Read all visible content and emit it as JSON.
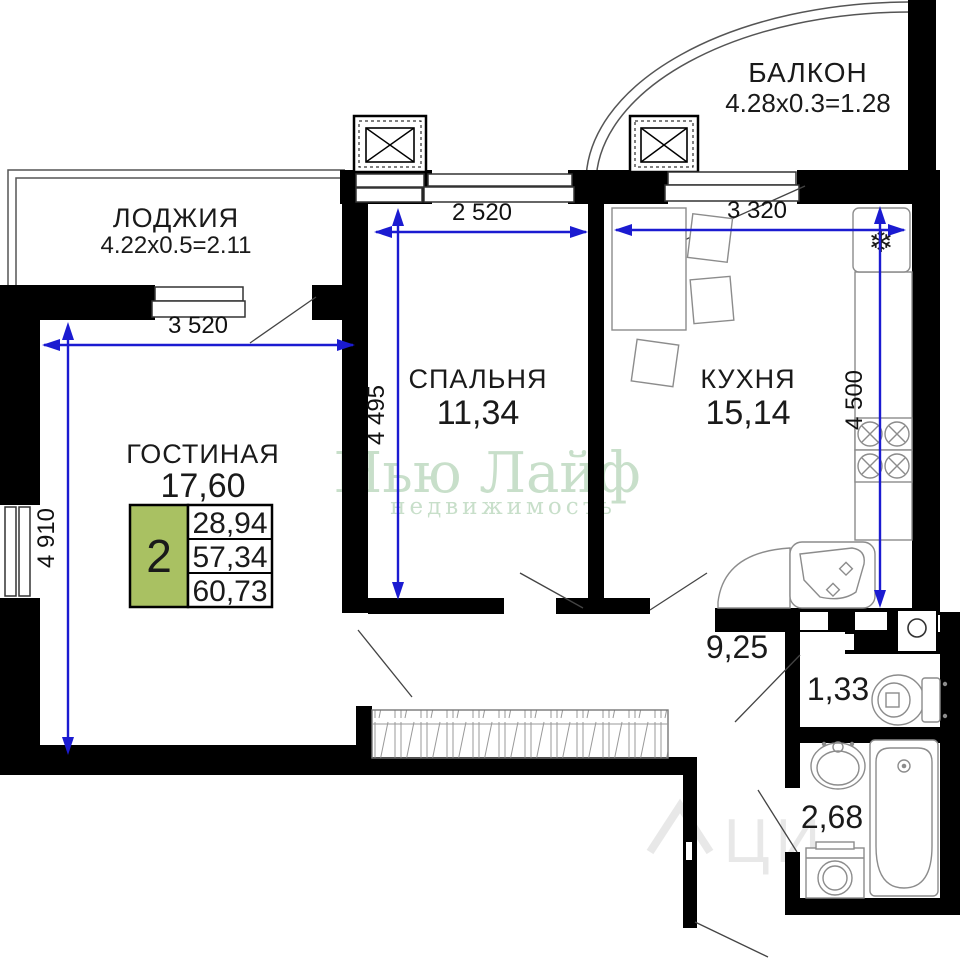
{
  "rooms": {
    "balcony": {
      "name": "БАЛКОН",
      "dims": "4.28x0.3=1.28"
    },
    "loggia": {
      "name": "ЛОДЖИЯ",
      "dims": "4.22x0.5=2.11"
    },
    "bedroom": {
      "name": "СПАЛЬНЯ",
      "area": "11,34"
    },
    "kitchen": {
      "name": "КУХНЯ",
      "area": "15,14"
    },
    "living": {
      "name": "ГОСТИНАЯ",
      "area": "17,60"
    },
    "hallway": {
      "area": "9,25"
    },
    "wc": {
      "area": "1,33"
    },
    "bathroom": {
      "area": "2,68"
    }
  },
  "dimensions": {
    "loggia_width": "3 520",
    "living_height": "4 910",
    "bedroom_width": "2 520",
    "bedroom_height": "4 495",
    "kitchen_width": "3 320",
    "kitchen_height": "4 500"
  },
  "info_table": {
    "room_count": "2",
    "row1": "28,94",
    "row2": "57,34",
    "row3": "60,73"
  },
  "watermark": {
    "line1": "Нью Лайф",
    "line2": "недвижимость",
    "faint": "ЦИ"
  },
  "colors": {
    "wall": "#000000",
    "dimension_blue": "#1b1bd1",
    "table_green": "#a9c162",
    "watermark_green": "#c8dfca"
  }
}
